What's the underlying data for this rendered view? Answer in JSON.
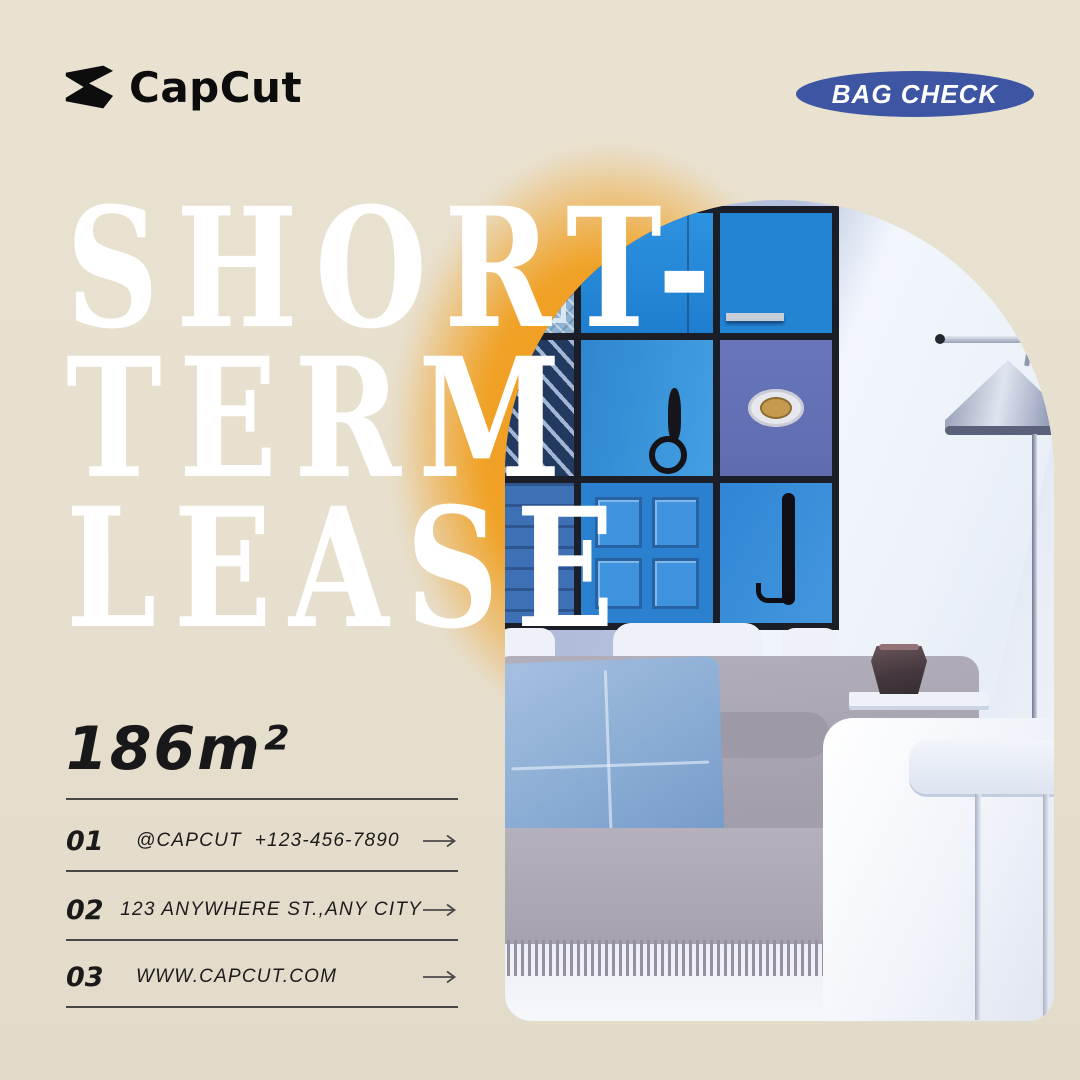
{
  "poster": {
    "brand": {
      "name": "CapCut"
    },
    "badge": {
      "label": "BAG CHECK"
    },
    "title": {
      "line1": "SHORT-",
      "line2": "TERM",
      "line3": "LEASE"
    },
    "area_label": "186m²",
    "contacts": [
      {
        "num": "01",
        "label": "@CAPCUT  +123-456-7890"
      },
      {
        "num": "02",
        "label": "123 ANYWHERE ST.,ANY CITY"
      },
      {
        "num": "03",
        "label": "WWW.CAPCUT.COM"
      }
    ],
    "colors": {
      "background": "#e8e0ce",
      "glow_orange": "#f0a125",
      "badge_blue": "#3d55a3",
      "title_white": "#ffffff",
      "text_black": "#18181a"
    }
  }
}
